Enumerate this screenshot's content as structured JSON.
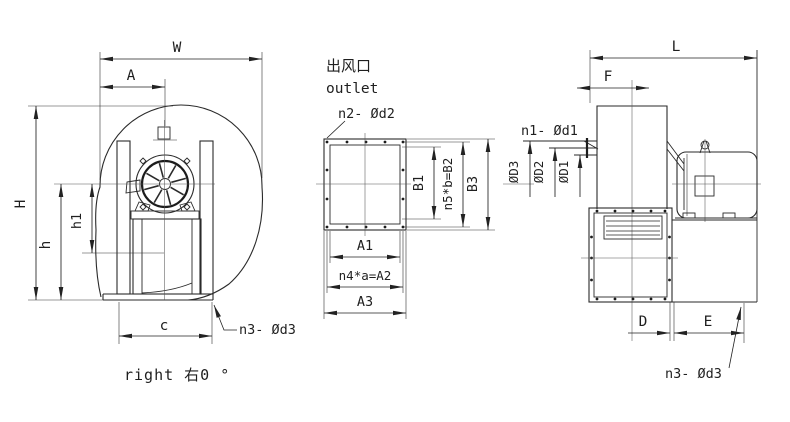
{
  "caption": "right 右0 °",
  "left": {
    "w": "W",
    "a": "A",
    "h_total": "H",
    "h": "h",
    "h1": "h1",
    "c": "c",
    "note": "n3- Ød3"
  },
  "middle": {
    "cn": "出风口",
    "en": "outlet",
    "note": "n2- Ød2",
    "b1": "B1",
    "b2": "n5*b=B2",
    "b3": "B3",
    "a1": "A1",
    "a2": "n4*a=A2",
    "a3": "A3"
  },
  "right": {
    "l": "L",
    "f": "F",
    "d": "D",
    "e": "E",
    "d1": "ØD1",
    "d2": "ØD2",
    "d3": "ØD3",
    "note_inlet": "n1- Ød1",
    "note_base": "n3- Ød3"
  }
}
